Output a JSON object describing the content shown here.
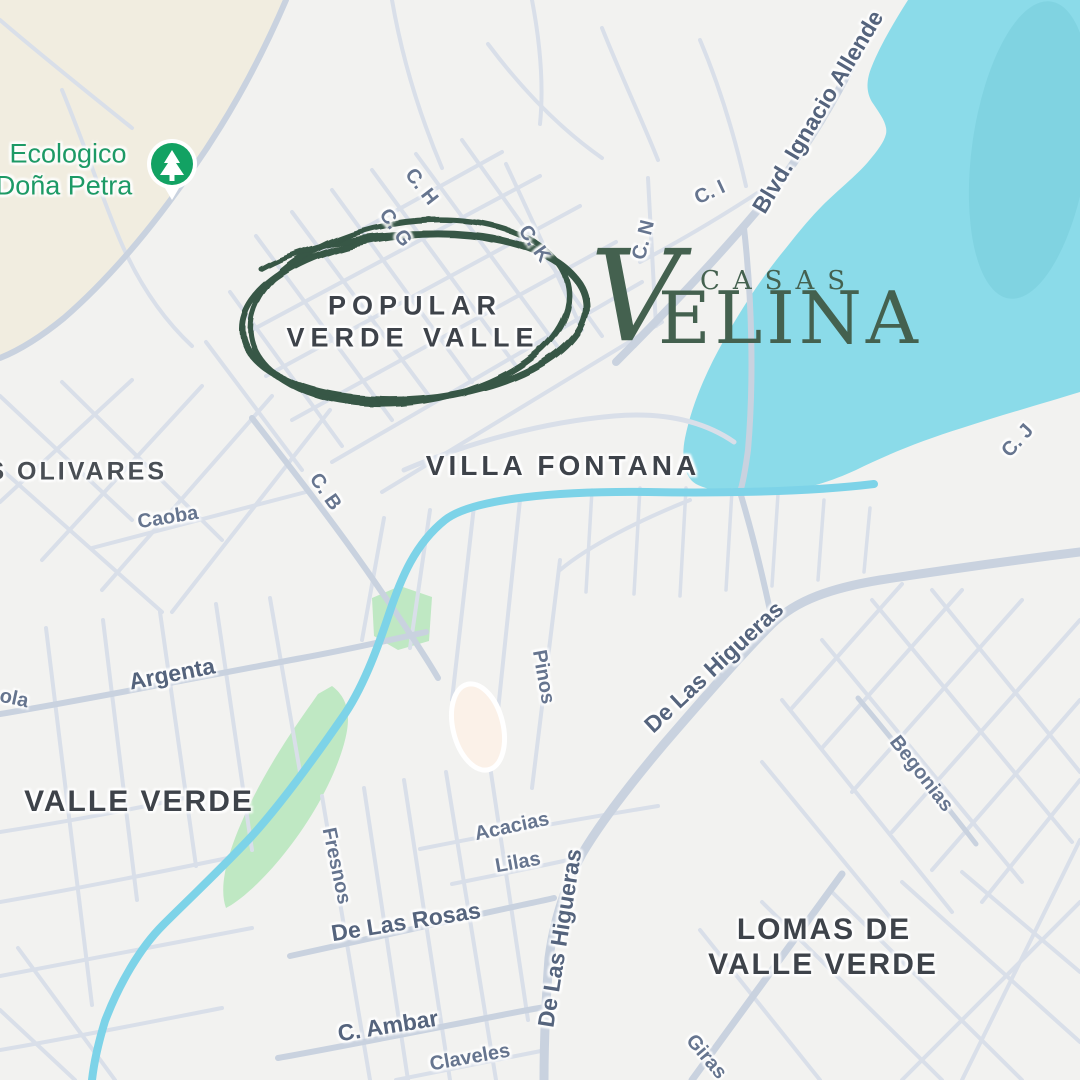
{
  "map": {
    "park_poi": {
      "label_line1": "Ecologico",
      "label_line2": "Doña Petra",
      "pin_icon": "tree-icon",
      "pin_color": "#12a263",
      "label_color": "#1d9a66"
    },
    "area_labels": [
      {
        "name": "area-label-popular-line1",
        "text": "POPULAR",
        "x": 415,
        "y": 306,
        "r": 0,
        "cls": "area-c"
      },
      {
        "name": "area-label-popular-line2",
        "text": "VERDE VALLE",
        "x": 413,
        "y": 338,
        "r": 0,
        "cls": "area-c"
      },
      {
        "name": "area-label-villa-fontana",
        "text": "VILLA FONTANA",
        "x": 563,
        "y": 466,
        "r": 0,
        "cls": "area"
      },
      {
        "name": "area-label-los-olivares",
        "text": "OS OLIVARES",
        "x": 66,
        "y": 472,
        "r": 0,
        "cls": "area-sm"
      },
      {
        "name": "area-label-valle-verde",
        "text": "VALLE VERDE",
        "x": 139,
        "y": 802,
        "r": 0,
        "cls": "area-lg"
      },
      {
        "name": "area-label-lomas-line1",
        "text": "LOMAS DE",
        "x": 824,
        "y": 930,
        "r": 0,
        "cls": "area-lg"
      },
      {
        "name": "area-label-lomas-line2",
        "text": "VALLE VERDE",
        "x": 823,
        "y": 965,
        "r": 0,
        "cls": "area-lg"
      },
      {
        "name": "park-label-line1",
        "text": "Ecologico",
        "x": 68,
        "y": 154,
        "r": 0,
        "cls": "park"
      },
      {
        "name": "park-label-line2",
        "text": "Doña Petra",
        "x": 64,
        "y": 186,
        "r": 0,
        "cls": "park"
      }
    ],
    "street_labels": [
      {
        "name": "street-label-c-h",
        "text": "C. H",
        "x": 421,
        "y": 187,
        "r": 52,
        "cls": "st"
      },
      {
        "name": "street-label-c-g",
        "text": "C. G",
        "x": 395,
        "y": 228,
        "r": 55,
        "cls": "st"
      },
      {
        "name": "street-label-c-k",
        "text": "C. K",
        "x": 534,
        "y": 244,
        "r": 55,
        "cls": "st"
      },
      {
        "name": "street-label-c-n",
        "text": "C. N",
        "x": 644,
        "y": 240,
        "r": -76,
        "cls": "st"
      },
      {
        "name": "street-label-c-i",
        "text": "C. I",
        "x": 710,
        "y": 193,
        "r": -25,
        "cls": "st"
      },
      {
        "name": "street-label-blvd-ignacio-allende",
        "text": "Blvd. Ignacio Allende",
        "x": 818,
        "y": 112,
        "r": -59,
        "cls": "stm"
      },
      {
        "name": "street-label-c-j",
        "text": "C. J",
        "x": 1018,
        "y": 441,
        "r": -48,
        "cls": "st"
      },
      {
        "name": "street-label-c-b",
        "text": "C. B",
        "x": 325,
        "y": 492,
        "r": 55,
        "cls": "st"
      },
      {
        "name": "street-label-caoba",
        "text": "Caoba",
        "x": 168,
        "y": 518,
        "r": -9,
        "cls": "st"
      },
      {
        "name": "street-label-ola",
        "text": "ola",
        "x": 14,
        "y": 699,
        "r": 12,
        "cls": "st"
      },
      {
        "name": "street-label-argenta",
        "text": "Argenta",
        "x": 172,
        "y": 674,
        "r": -11,
        "cls": "stm"
      },
      {
        "name": "street-label-pinos",
        "text": "Pinos",
        "x": 543,
        "y": 677,
        "r": 80,
        "cls": "st"
      },
      {
        "name": "street-label-de-las-higueras-diagonal",
        "text": "De Las Higueras",
        "x": 714,
        "y": 667,
        "r": -43,
        "cls": "stm"
      },
      {
        "name": "street-label-begonias",
        "text": "Begonias",
        "x": 921,
        "y": 774,
        "r": 52,
        "cls": "st"
      },
      {
        "name": "street-label-fresnos",
        "text": "Fresnos",
        "x": 336,
        "y": 866,
        "r": 78,
        "cls": "st"
      },
      {
        "name": "street-label-acacias",
        "text": "Acacias",
        "x": 512,
        "y": 827,
        "r": -12,
        "cls": "st"
      },
      {
        "name": "street-label-lilas",
        "text": "Lilas",
        "x": 518,
        "y": 863,
        "r": -10,
        "cls": "st"
      },
      {
        "name": "street-label-de-las-rosas",
        "text": "De Las Rosas",
        "x": 406,
        "y": 922,
        "r": -9,
        "cls": "stm"
      },
      {
        "name": "street-label-de-las-higueras-vertical",
        "text": "De Las Higueras",
        "x": 560,
        "y": 938,
        "r": -81,
        "cls": "stm"
      },
      {
        "name": "street-label-c-ambar",
        "text": "C. Ambar",
        "x": 388,
        "y": 1026,
        "r": -9,
        "cls": "stm"
      },
      {
        "name": "street-label-claveles",
        "text": "Claveles",
        "x": 470,
        "y": 1058,
        "r": -10,
        "cls": "st"
      },
      {
        "name": "street-label-girasoles-cut",
        "text": "Giras",
        "x": 706,
        "y": 1057,
        "r": 50,
        "cls": "st"
      }
    ]
  },
  "annotation": {
    "circled_area_line1": "POPULAR",
    "circled_area_line2": "VERDE VALLE",
    "circle_color": "#2f4f3d"
  },
  "logo": {
    "word_top": "CASAS",
    "word_main_initial": "V",
    "word_main_rest": "ELINA",
    "color": "#44614f"
  },
  "colors": {
    "map_background": "#f2f2f0",
    "water": "#8bdbe9",
    "water_shade": "#80d3e1",
    "park_beige": "#f1ede0",
    "green_area": "#bfe8c3",
    "stream": "#7dd3e8",
    "road_main": "#c9d2df",
    "road_minor": "#d9dfe9",
    "street_label": "#66758f",
    "street_label_main": "#55647d",
    "area_label": "#3e434a",
    "park_label": "#1d9a66",
    "pin_green": "#12a263"
  }
}
